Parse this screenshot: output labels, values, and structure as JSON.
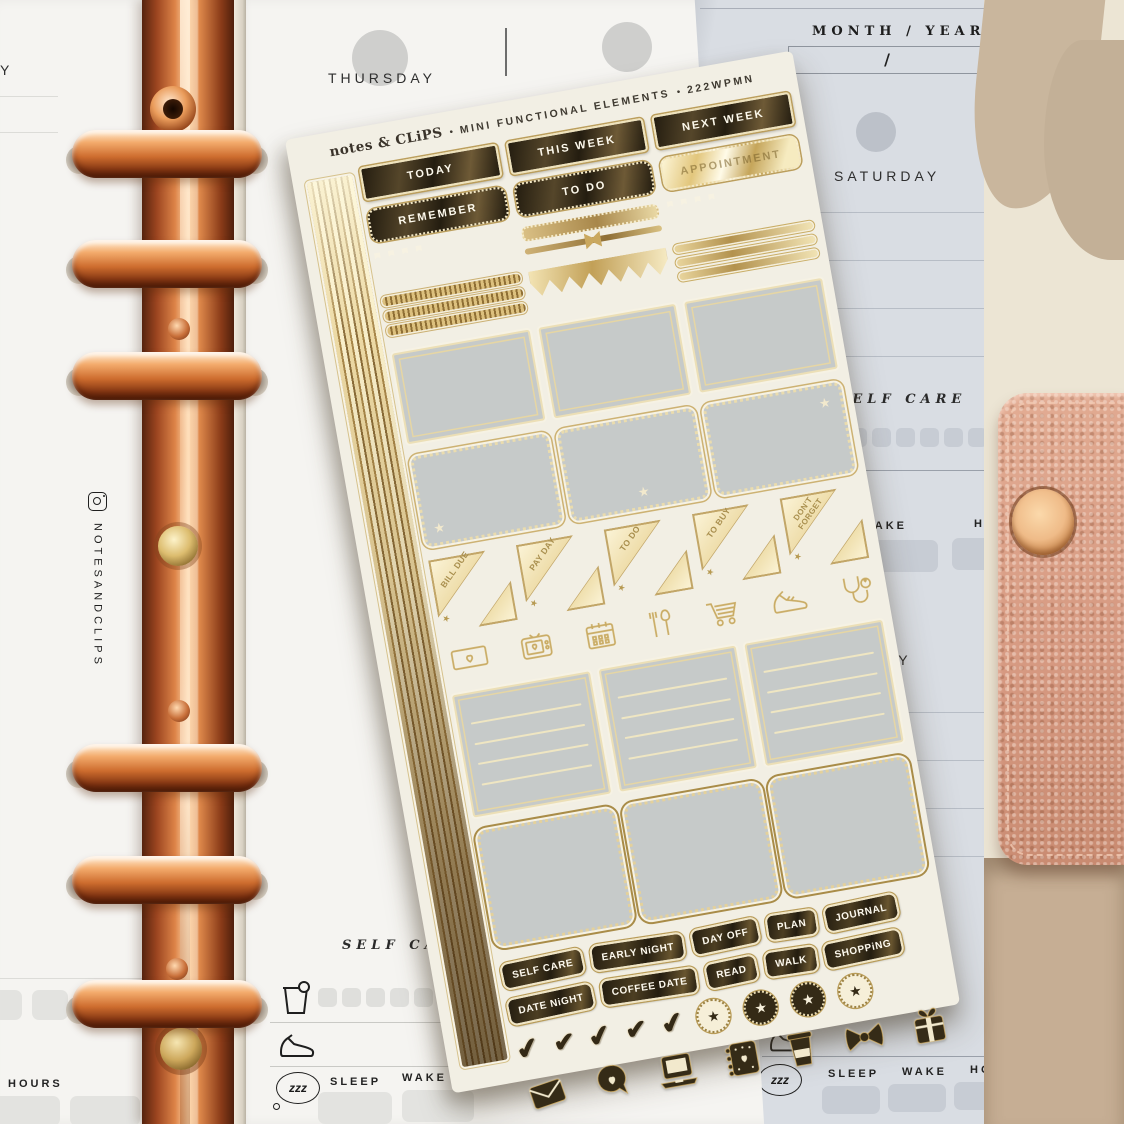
{
  "colors": {
    "gold_foil": "#d8bd7f",
    "gold_bright": "#f7ecc8",
    "foil_dark": "#3c3322",
    "sheet_cream": "#f2efe4",
    "sticker_gray": "#c6cac9",
    "copper_binder": "#c06434",
    "strap_pink": "#d89d86",
    "page_white": "#f5f4f1",
    "page_blue": "#d9dde3",
    "background_cream": "#ebe3d1",
    "background_tan": "#c9b69d"
  },
  "sheet": {
    "brand": "notes & CLiPS",
    "bullet": "•",
    "series": "MINI FUNCTIONAL ELEMENTS",
    "sku": "222WPMN",
    "headers": [
      "TODAY",
      "THIS WEEK",
      "NEXT WEEK"
    ],
    "sub_headers": [
      "REMEMBER",
      "TO DO",
      "APPOINTMENT"
    ],
    "corner_labels": [
      "BILL DUE",
      "PAY DAY",
      "TO DO",
      "TO BUY",
      "DON'T FORGET"
    ],
    "word_row1": [
      "SELF CARE",
      "EARLY NiGHT",
      "DAY OFF",
      "PLAN",
      "JOURNAL"
    ],
    "word_row2": [
      "DATE NiGHT",
      "COFFEE DATE",
      "READ",
      "WALK",
      "SHOPPiNG"
    ],
    "icon_row1": [
      "money-bill",
      "tv-heart",
      "calendar",
      "utensils",
      "shopping-cart",
      "sneaker",
      "stethoscope"
    ],
    "icon_row2": [
      "envelope",
      "speech-bubble-heart",
      "laptop",
      "planner-book",
      "coffee-cup",
      "bow",
      "gift"
    ],
    "check_glyph": "✔",
    "star_glyph": "★"
  },
  "planner": {
    "instagram_handle": "NOTESANDCLIPS",
    "labels": {
      "sleep": "SLEEP",
      "wake": "WAKE",
      "hours": "HOURS",
      "self_care": "SELF CARE",
      "zzz": "zzz"
    },
    "left": {
      "day": "THURSDAY",
      "edge": "Y",
      "n": [
        "1.",
        "2.",
        "3."
      ]
    },
    "right": {
      "month_year_label": "MONTH / YEAR:",
      "month_year_value": "/",
      "day": "SATURDAY",
      "day_partial": "AY"
    }
  }
}
